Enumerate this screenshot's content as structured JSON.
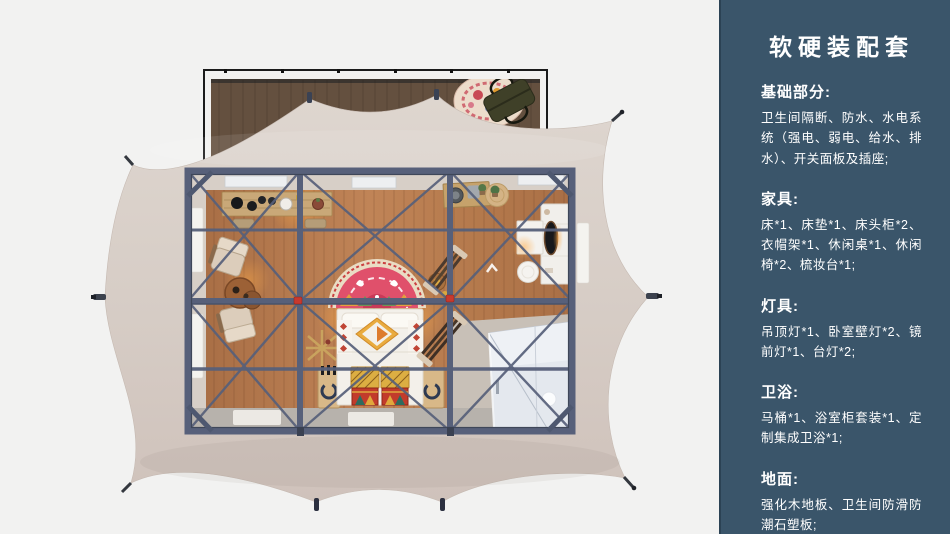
{
  "panel": {
    "title": "软硬装配套",
    "sections": [
      {
        "heading": "基础部分:",
        "body": "卫生间隔断、防水、水电系统（强电、弱电、给水、排水）、开关面板及插座;"
      },
      {
        "heading": "家具:",
        "body": "床*1、床垫*1、床头柜*2、衣帽架*1、休闲桌*1、休闲椅*2、梳妆台*1;"
      },
      {
        "heading": "灯具:",
        "body": "吊顶灯*1、卧室壁灯*2、镜前灯*1、台灯*2;"
      },
      {
        "heading": "卫浴:",
        "body": "马桶*1、浴室柜套装*1、定制集成卫浴*1;"
      },
      {
        "heading": "地面:",
        "body": "强化木地板、卫生间防滑防潮石塑板;"
      }
    ]
  },
  "illustration": {
    "description": "top-down 3d cutaway render of a glamping safari tent with interior furnishing",
    "parts": [
      "tent-canopy",
      "wood-deck",
      "deck-rug",
      "travel-bag",
      "steel-frame",
      "bed",
      "headboard-rug",
      "storage-chests",
      "lounge-chairs",
      "tea-table",
      "console-table",
      "clothes-rack",
      "washstand",
      "vanity-mirror",
      "stool",
      "integrated-bathroom",
      "guy-line-pegs"
    ]
  },
  "colors": {
    "panel": "#3a556a",
    "bg": "#f2f2f1",
    "canopy": "#d8cec7",
    "deck": "#64503f",
    "frame": "#57607a",
    "floor": "#b3784e",
    "bath": "#e4e8ee",
    "accent_red": "#c8392e"
  }
}
